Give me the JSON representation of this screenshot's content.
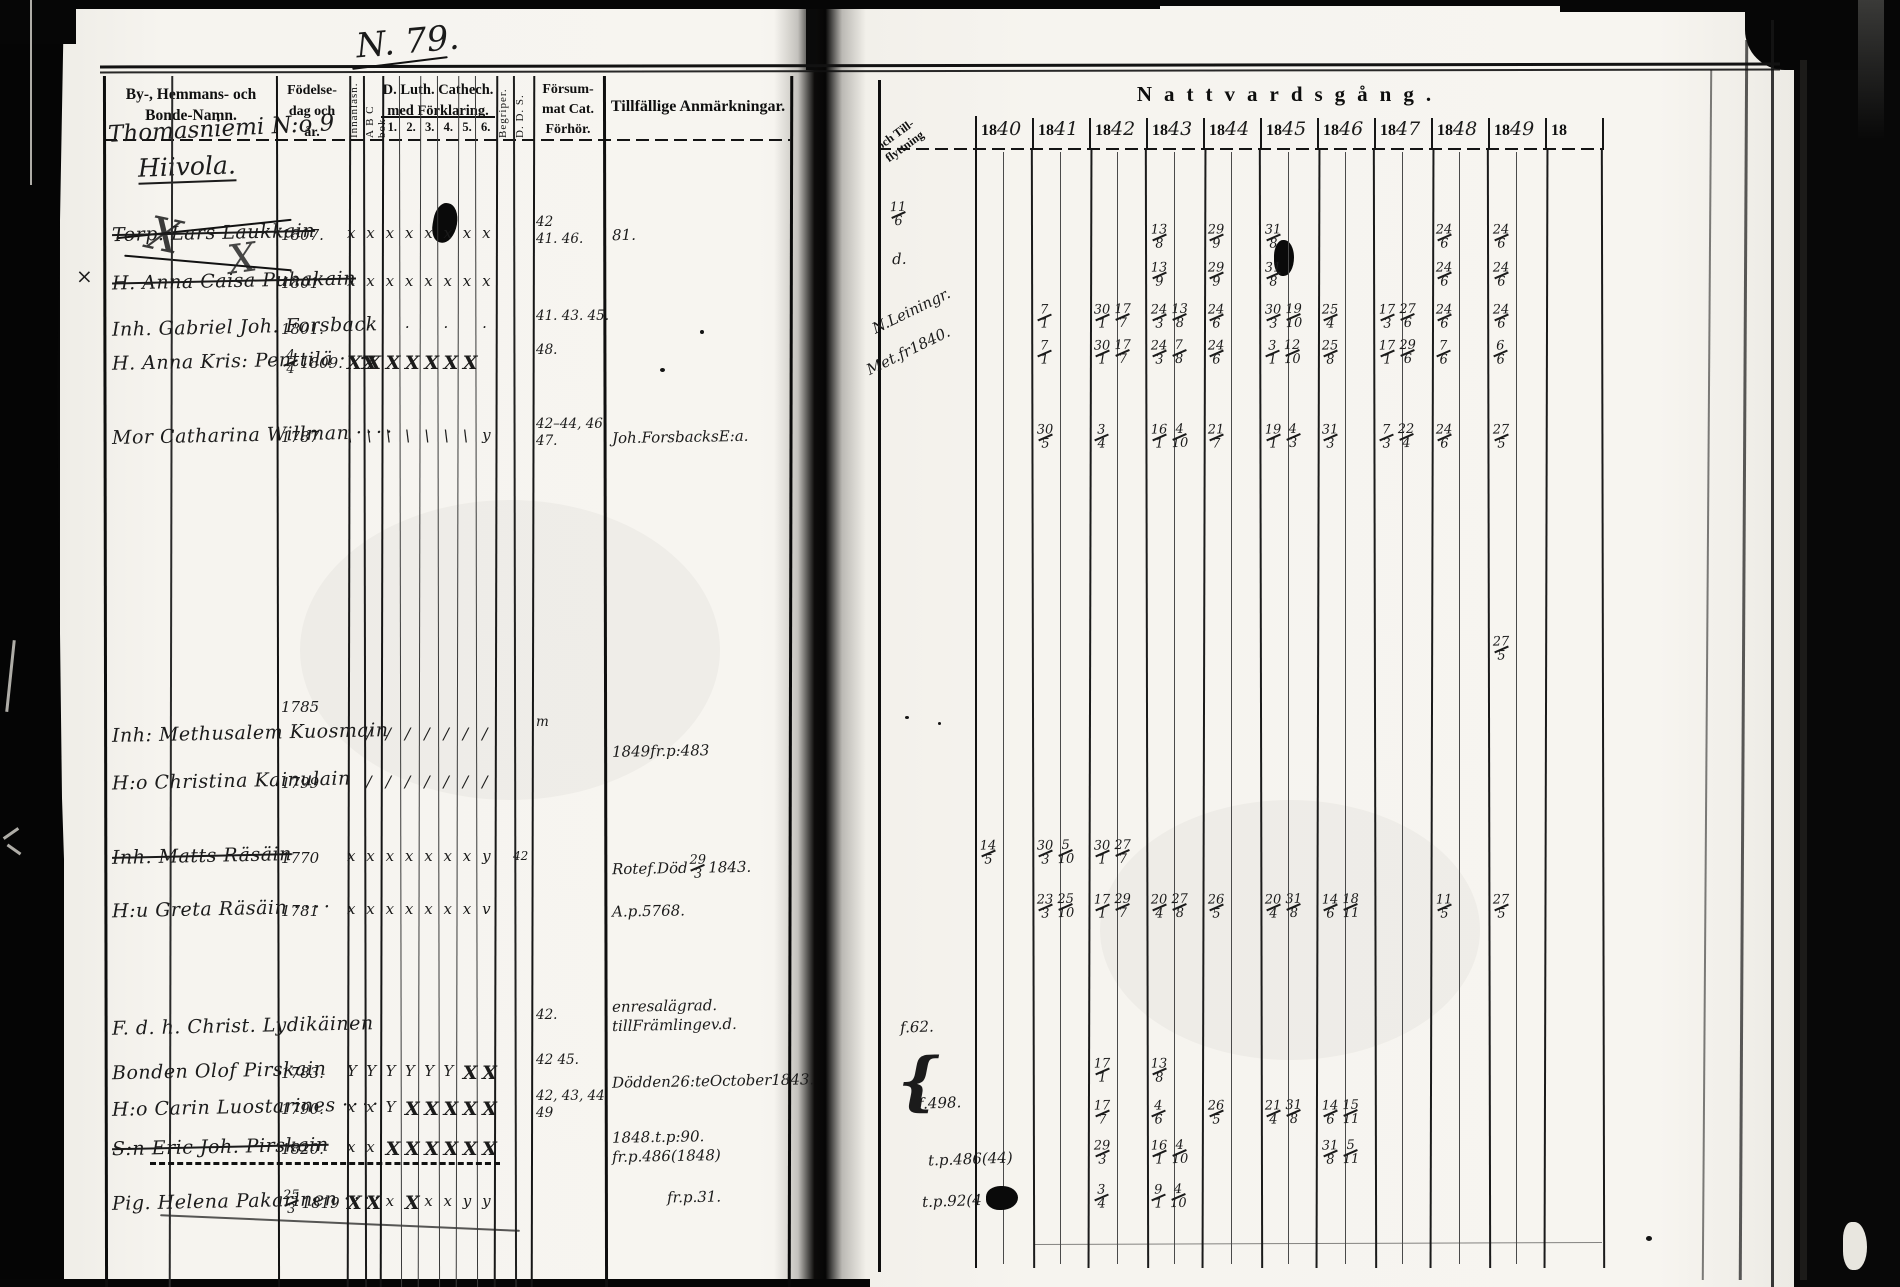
{
  "scan": {
    "page_number": "N. 79."
  },
  "colors": {
    "paper": "#f5f3ee",
    "ink": "#1b1b1b",
    "print": "#101010"
  },
  "left_page": {
    "header": {
      "names_line1": "By-, Hemmans- och",
      "names_line2": "Bonde-Namn.",
      "birth_line1": "Födelse-",
      "birth_line2": "dag och",
      "birth_line3": "år.",
      "innanlasn": "Innanläsn.",
      "abc": "A B C bok.",
      "cat_line1": "D. Luth. Cathech.",
      "cat_line2": "med Förklaring.",
      "cat_numbers": [
        "1.",
        "2.",
        "3.",
        "4.",
        "5.",
        "6."
      ],
      "begriper": "Begriper.",
      "dds": "D. D. S.",
      "fors_line1": "Försum-",
      "fors_line2": "mat Cat.",
      "fors_line3": "Förhör.",
      "anmarkningar": "Tillfällige Anmärkningar.",
      "village_line1": "Thomasniemi N:o 9",
      "village_line2": "Hiivola."
    }
  },
  "right_page": {
    "flytt_line1": "och Till-",
    "flytt_line2": "flyttning",
    "title": "Nattvardsgång.",
    "year_prefix": "18",
    "years": [
      "40",
      "41",
      "42",
      "43",
      "44",
      "45",
      "46",
      "47",
      "48",
      "49",
      ""
    ]
  },
  "rows": [
    {
      "name": "Torp. Lars Laukkain",
      "struck": true,
      "birth": "1807.",
      "marks": [
        "x",
        "x",
        "x",
        "x",
        "x",
        "x",
        "x",
        "x"
      ],
      "forsummat": [
        "42",
        "41. 46."
      ],
      "anm": [
        "81."
      ],
      "anm_struck": true,
      "flytt": "11/6",
      "communion": {
        "1843": "13/8",
        "1844": "29/9",
        "1845": "31/8",
        "1848": "24/6",
        "1849": "24/6"
      }
    },
    {
      "name": "H. Anna Caisa Puhakain",
      "struck": true,
      "birth": "1801",
      "marks": [
        "x",
        "x",
        "x",
        "x",
        "x",
        "x",
        "x",
        "x"
      ],
      "margin_mark": "×",
      "flytt": "d.",
      "communion": {
        "1843": "13/9",
        "1844": "29/9",
        "1845": "31/8",
        "1848": "24/6",
        "1849": "24/6"
      }
    },
    {
      "name": "Inh. Gabriel Joh. Forsback",
      "birth": "1801.",
      "marks": [
        "",
        "·",
        "",
        "·",
        "",
        "·",
        "",
        "·"
      ],
      "forsummat": [
        "41. 43. 45."
      ],
      "flytt": "N. Leiningr.",
      "flytt_slant": true,
      "communion": {
        "1841": "7/1",
        "1842": "30/1 17/7",
        "1843": "24/3 13/8",
        "1844": "24/6",
        "1845": "30/3 19/10",
        "1846": "25/4",
        "1847": "17/3 27/6",
        "1848": "24/6",
        "1849": "24/6"
      }
    },
    {
      "name": "H. Anna Kris: Penttilä",
      "dots": true,
      "birth": "4/4 1809.",
      "marks": [
        "XX",
        "X",
        "X",
        "X",
        "X",
        "X",
        "X"
      ],
      "forsummat": [
        "48."
      ],
      "flytt": "Met. fr 1840.",
      "flytt_slant": true,
      "communion": {
        "1841": "7/1",
        "1842": "30/1 17/7",
        "1843": "24/3 7/8",
        "1844": "24/6",
        "1845": "3/1 12/10",
        "1846": "25/8",
        "1847": "17/1 29/6",
        "1848": "7/6",
        "1849": "6/6"
      }
    },
    {
      "name": "Mor Catharina Willman",
      "dots": true,
      "birth": "1787",
      "marks": [
        "\\",
        "\\",
        "\\",
        "\\",
        "\\",
        "\\",
        "\\",
        "y"
      ],
      "forsummat": [
        "42–44, 46",
        "47."
      ],
      "anm": [
        "Joh. Forsbacks E:a."
      ],
      "communion": {
        "1841": "30/5",
        "1842": "3/4",
        "1843": "16/1 4/10",
        "1844": "21/7",
        "1845": "19/1 4/3",
        "1846": "31/3",
        "1847": "7/3 22/4",
        "1848": "24/6",
        "1849": "27/5"
      }
    },
    {
      "name": "Inh: Methusalem Kuosmain",
      "birth": "1785",
      "birth_up": true,
      "marks": [
        "",
        "/",
        "/",
        "/",
        "/",
        "/",
        "/",
        "/"
      ],
      "forsummat": [
        "m"
      ],
      "communion": {}
    },
    {
      "name": "H:o Christina Kainulain",
      "birth": "1799",
      "marks": [
        "",
        "/",
        "/",
        "/",
        "/",
        "/",
        "/",
        "/"
      ],
      "anm": [
        "1849 fr. p: 483"
      ],
      "communion": {
        "1849": "27/5"
      }
    },
    {
      "name": "Inh. Matts Räsäin",
      "struck": true,
      "birth": "1770",
      "marks": [
        "x",
        "x",
        "x",
        "x",
        "x",
        "x",
        "x",
        "y"
      ],
      "dds": "42",
      "anm": [
        "Rotef. Död 29/3 1843."
      ],
      "communion": {
        "1840": "14/5",
        "1841": "30/3 5/10",
        "1842": "30/1 27/7"
      }
    },
    {
      "name": "H:u Greta Räsäin",
      "dots": true,
      "birth": "1781",
      "marks": [
        "x",
        "x",
        "x",
        "x",
        "x",
        "x",
        "x",
        "v"
      ],
      "anm": [
        "A. p. 5768."
      ],
      "communion": {
        "1841": "23/3 25/10",
        "1842": "17/1 29/7",
        "1843": "20/4 27/8",
        "1844": "26/5",
        "1845": "20/4 31/8",
        "1846": "14/6 18/11",
        "1848": "11/5",
        "1849": "27/5"
      }
    },
    {
      "name": "F. d. h. Christ. Lydikäinen",
      "marks": [],
      "forsummat": [
        "42."
      ],
      "anm": [
        "en resa lägrad.",
        "till Främlinge v.d."
      ],
      "anm_small": true,
      "flytt": "f. 62.",
      "communion": {}
    },
    {
      "name": "Bonden Olof Pirskain",
      "birth": "1783.",
      "marks": [
        "Y",
        "Y",
        "Y",
        "Y",
        "Y",
        "Y",
        "X",
        "X"
      ],
      "forsummat": [
        "42  45."
      ],
      "anm": [
        "Död den 26:te October 1843."
      ],
      "communion": {
        "1842": "17/1",
        "1843": "13/8"
      }
    },
    {
      "name": "H:o Carin Luostarines",
      "dots": true,
      "birth": "1790.",
      "marks": [
        "x",
        "x",
        "Y",
        "X",
        "X",
        "X",
        "X",
        "X"
      ],
      "forsummat": [
        "42, 43, 44",
        "49"
      ],
      "flytt": "f. 498.",
      "flytt_brace": true,
      "communion": {
        "1842": "17/7",
        "1843": "4/6",
        "1844": "26/5",
        "1845": "21/4 31/8",
        "1846": "14/6 15/11"
      }
    },
    {
      "name": "S:n Eric Joh. Pirskain",
      "struck": true,
      "dashed": true,
      "birth": "1820.",
      "marks": [
        "x",
        "x",
        "X",
        "X",
        "X",
        "X",
        "X",
        "X"
      ],
      "anm": [
        "1848. t. p: 90.",
        "fr. p. 486 (1848)"
      ],
      "anm_small": true,
      "flytt": "t. p. 486 (44)",
      "communion": {
        "1842": "29/3",
        "1843": "16/1 4/10",
        "1846": "31/8 5/11"
      }
    },
    {
      "name": "Pig. Helena Pakarinen",
      "dots": true,
      "birth": "25/3 1819",
      "marks": [
        "X",
        "X",
        "x",
        "X",
        "x",
        "x",
        "y",
        "y"
      ],
      "anm": [
        "fr. p. 31."
      ],
      "anm_dx": 55,
      "flytt": "t. p. 92 (4",
      "flytt_struck": true,
      "flytt_blot": true,
      "communion": {
        "1842": "3/4",
        "1843": "9/1 4/10"
      }
    }
  ]
}
